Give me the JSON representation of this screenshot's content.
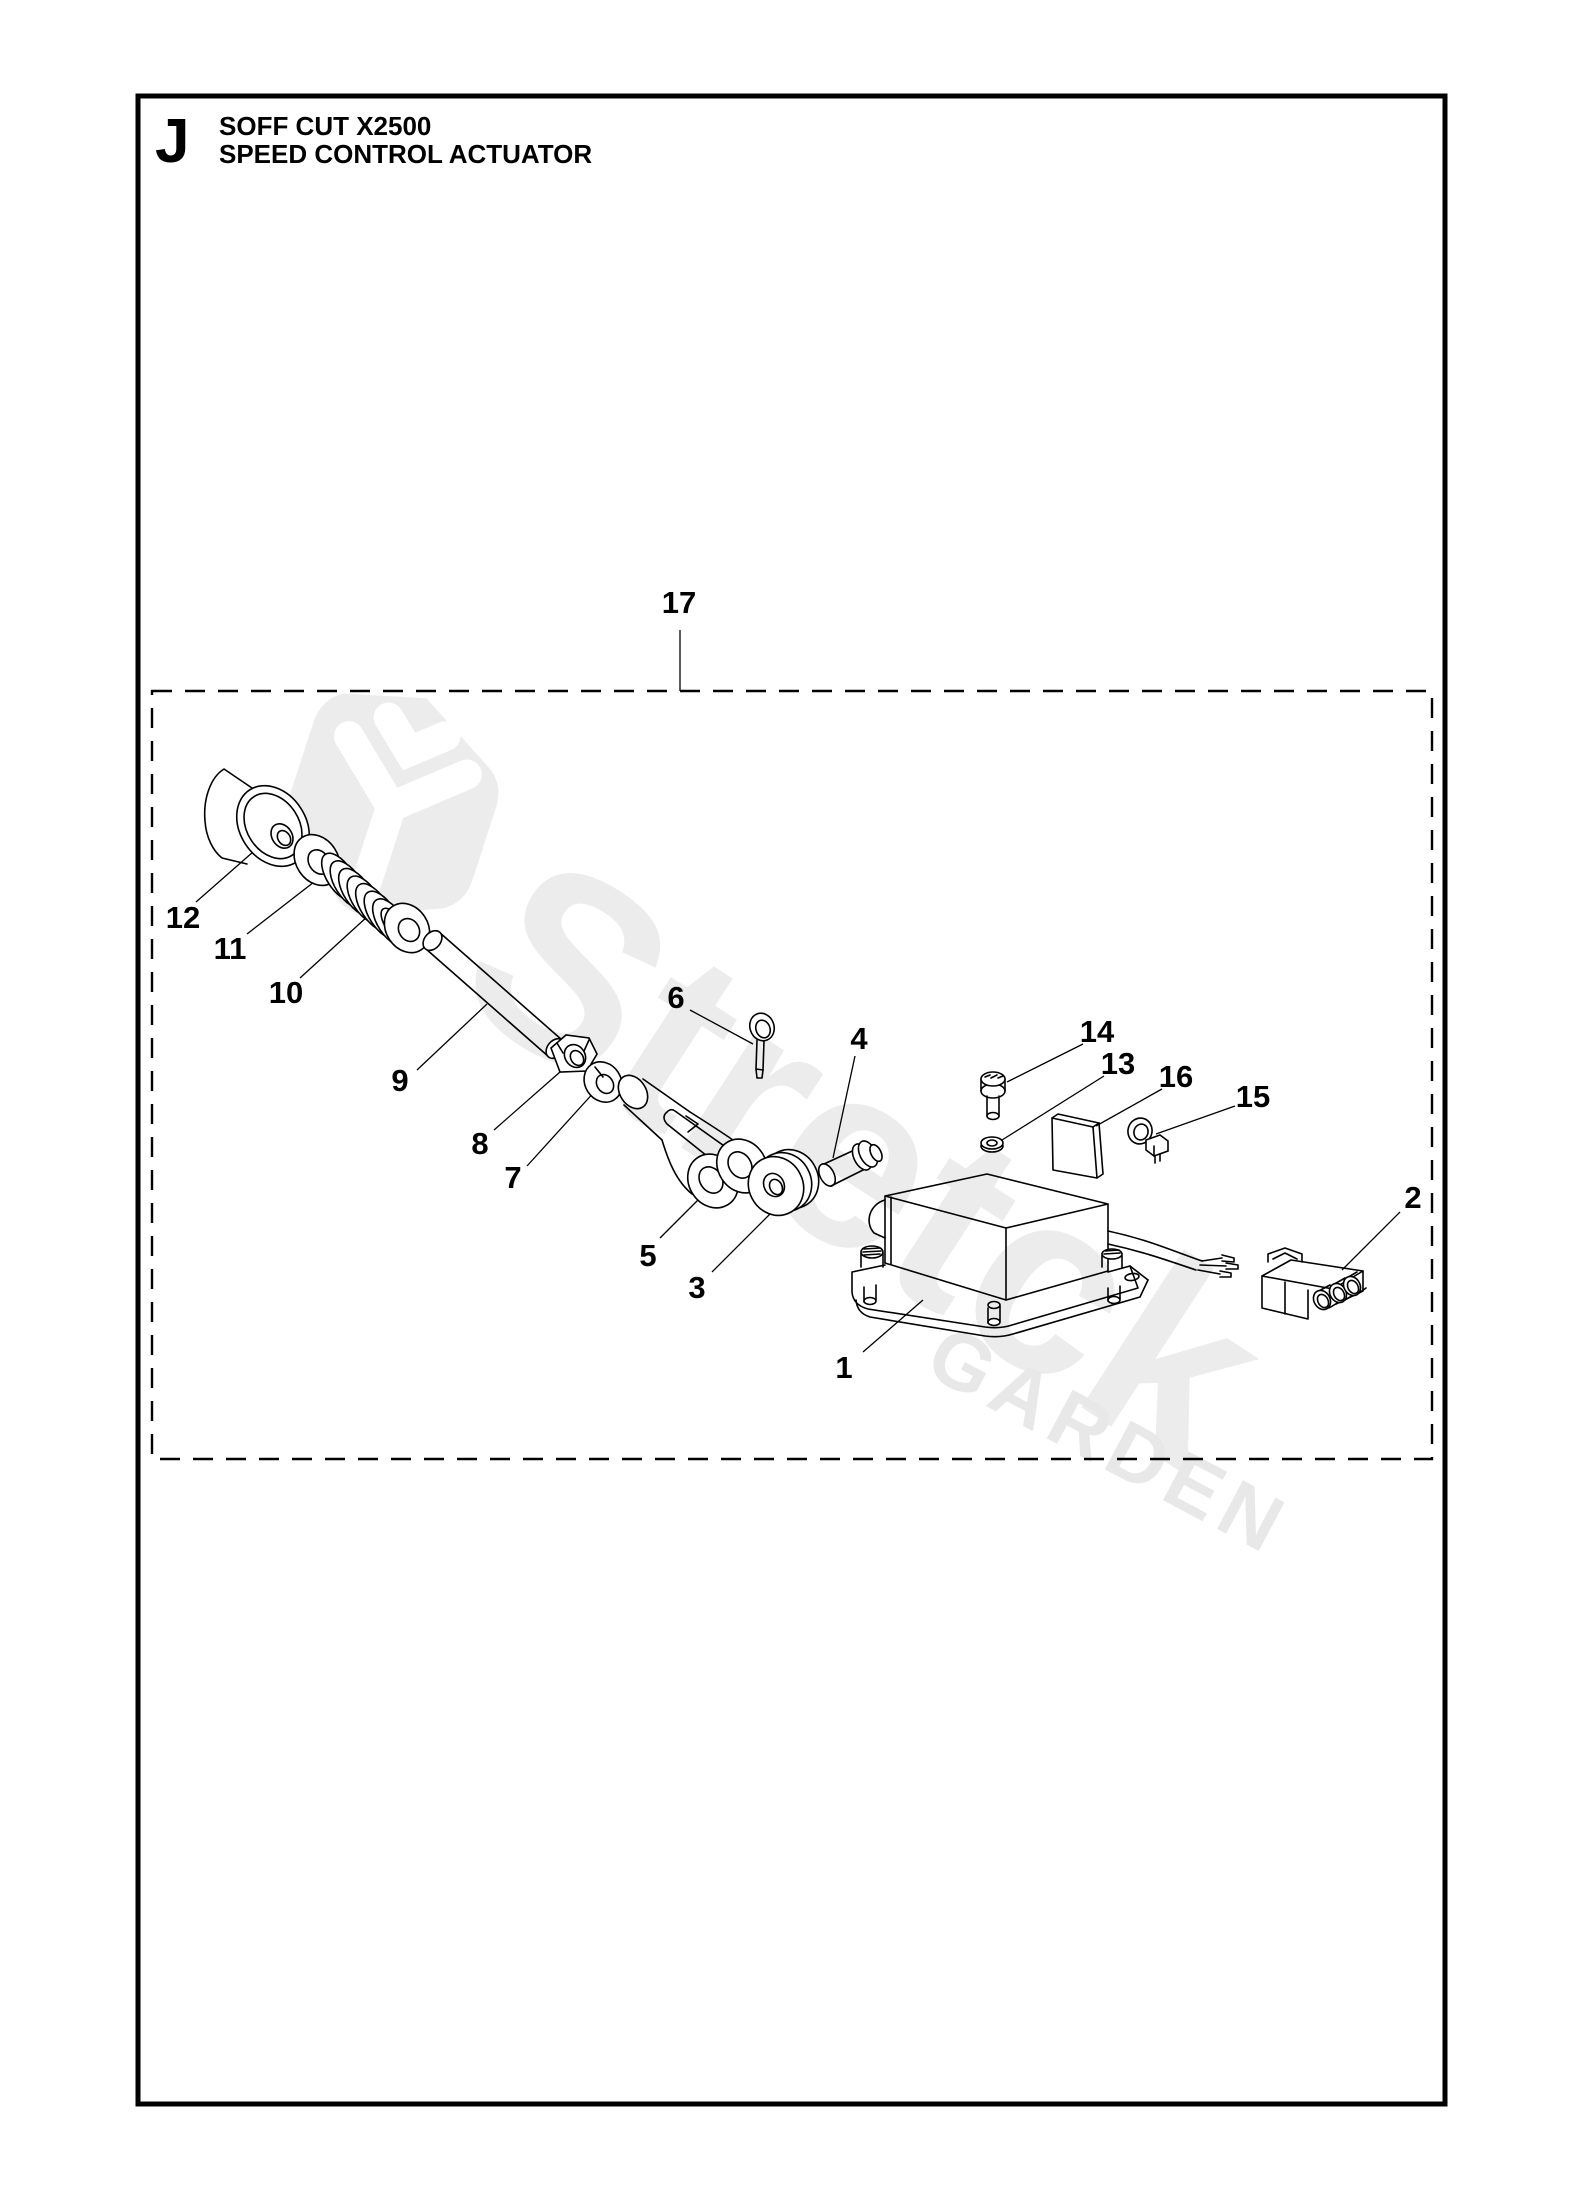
{
  "header": {
    "section_letter": "J",
    "title_line1": "SOFF CUT X2500",
    "title_line2": "SPEED CONTROL ACTUATOR"
  },
  "labels": {
    "n1": "1",
    "n2": "2",
    "n3": "3",
    "n4": "4",
    "n5": "5",
    "n6": "6",
    "n7": "7",
    "n8": "8",
    "n9": "9",
    "n10": "10",
    "n11": "11",
    "n12": "12",
    "n13": "13",
    "n14": "14",
    "n15": "15",
    "n16": "16",
    "n17": "17"
  },
  "watermark": {
    "brand": "Stretck",
    "sub": "GARDEN"
  },
  "colors": {
    "ink": "#000000",
    "paper": "#ffffff",
    "watermark_gray": "#ececec"
  }
}
